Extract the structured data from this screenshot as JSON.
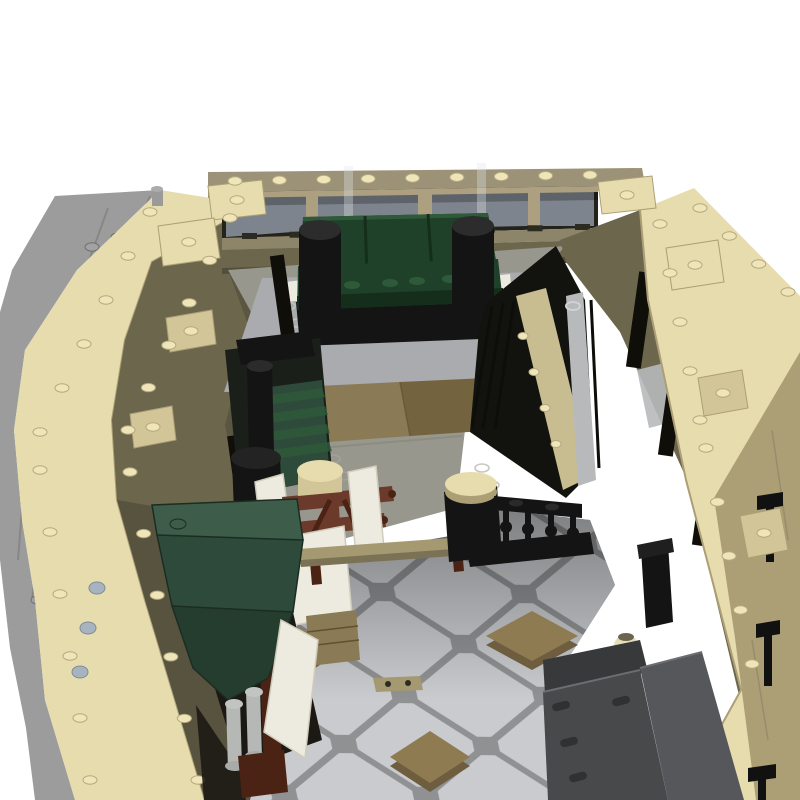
{
  "meta": {
    "title": "LEGO MOC modular building lobby - aerial 3D render",
    "alt": "Top-down angled render of a tan LEGO modular building with open roof showing a lobby: dark green sofa on a gray rug, rear window wall, wooden floor, brown coat stand with white privacy screens, black stair railing, dark green entrance awning with white door and gray columns, gray octagonal stone tile floor with dark tan diamond inlays, dark gray stone benches and black wall lamps, gray studded sidewalk baseplate along the left."
  },
  "colors": {
    "page_bg": "#ffffff",
    "plate": "#9c9c9c",
    "plate_seam": "#7f7f7f",
    "tan_bright": "#e6dcae",
    "tan_mid": "#d2c698",
    "tan_shadow": "#ac9f76",
    "tan_deep": "#8f8666",
    "olive": "#6c664d",
    "olive_dark": "#544f3a",
    "cornice": "#9c9277",
    "win_frame": "#23231c",
    "pane": "#7e848d",
    "mullion": "#aca081",
    "lintel": "#8d8569",
    "dash": "#2c2b22",
    "floor": "#98978d",
    "floor_seam": "#807f74",
    "rug": "#a9abae",
    "wood": "#8a7a55",
    "wood_dark": "#73643f",
    "green": "#1f4029",
    "green_lt": "#2e5a3a",
    "green_dk": "#152e1c",
    "black": "#141414",
    "pillar": "#b7b9bb",
    "steel": "#a7b4bf",
    "stair_tan": "#c8bc91",
    "awn1": "#3d5c4a",
    "awn2": "#2e4a3a",
    "awn3": "#253d2f",
    "awn_edge": "#1b2d22",
    "brown": "#6b3a2a",
    "brown_dk": "#4b2315",
    "white_panel": "#edebe0",
    "panel_edge": "#cfccbc",
    "bench_tan": "#a59972",
    "tile": "#c9cbce",
    "tile_gap": "#8f9193",
    "dia_top": "#8f7b52",
    "dia_side": "#6e5e3f",
    "bgray": "#47494b",
    "bgray2": "#55575a",
    "pill": "#2f3133",
    "vase": "#e6deb6",
    "stud_b": "#efe5b9",
    "stud_edge": "#b3a87e",
    "stud_g": "#a2a2a2",
    "stud_g_edge": "#6e6e6e",
    "void": "#12120e",
    "slit": "#0f0e09",
    "door_dark": "#1c1914",
    "lamp": "#111111"
  },
  "objects": {
    "building": "Tan LEGO modular building shell, open roof, viewed from above",
    "sidewalk": "Gray studded baseplate sidewalk along the left side",
    "back_windows": "Row of gray-blue windows on rear wall",
    "sofa": "Dark green three-seat sofa with black cylinder armrests",
    "rug": "Light gray area rug with stud marks",
    "wood_floor": "Dark tan wooden plank flooring",
    "green_stack": "Dark green rolled-awning stack with black pot and pipe",
    "coat_rack": "Reddish-brown coat stand with cream hat box",
    "screens": "White folding privacy screens",
    "bench": "Tan bench seat with dark legs",
    "stool": "Black stool with cream round cushion",
    "railing": "Black guard railing with turned balusters",
    "stairwell": "Open stair void with tan stringer and light gray column",
    "awning": "Dark green faceted entrance awning",
    "door": "White door panel leaning at the entrance",
    "columns": "Light gray turned porch columns on brown pedestal",
    "tile_floor": "Gray octagonal stone tile floor",
    "diamonds": "Dark tan diamond tile inlays",
    "stone_bench": "Dark gray stone bench slabs, bottom right",
    "vase": "Cream ribbed vase",
    "lamps": "Black wall lamps on right facade"
  },
  "decor": {
    "stud_rows_bright": [
      [
        150,
        212,
        40,
        432,
        6
      ],
      [
        40,
        470,
        90,
        780,
        6
      ],
      [
        230,
        218,
        128,
        430,
        6
      ],
      [
        130,
        472,
        198,
        780,
        6
      ],
      [
        660,
        224,
        700,
        420,
        5
      ],
      [
        706,
        448,
        752,
        664,
        5
      ],
      [
        700,
        208,
        788,
        292,
        4
      ],
      [
        235,
        181,
        590,
        175,
        9
      ]
    ],
    "stud_rows_gray": [
      [
        118,
        237,
        60,
        398,
        4
      ],
      [
        92,
        247,
        36,
        408,
        4
      ],
      [
        30,
        468,
        42,
        558,
        3
      ],
      [
        38,
        600,
        58,
        700,
        3
      ]
    ],
    "stringer_bumps": [
      [
        523,
        336
      ],
      [
        534,
        372
      ],
      [
        545,
        408
      ],
      [
        556,
        444
      ]
    ],
    "sofa_studs": [
      [
        325,
        287
      ],
      [
        352,
        285
      ],
      [
        390,
        283
      ],
      [
        417,
        281
      ],
      [
        450,
        279
      ],
      [
        477,
        277
      ]
    ],
    "slits": [
      [
        283,
        300,
        -8,
        14,
        90
      ],
      [
        258,
        390,
        -8,
        14,
        90
      ],
      [
        240,
        478,
        -8,
        14,
        86
      ],
      [
        230,
        562,
        -8,
        13,
        80
      ],
      [
        225,
        655,
        -6,
        13,
        66
      ],
      [
        245,
        735,
        -6,
        13,
        62
      ],
      [
        640,
        320,
        8,
        15,
        96
      ],
      [
        672,
        408,
        8,
        15,
        96
      ],
      [
        706,
        498,
        8,
        15,
        96
      ],
      [
        740,
        588,
        8,
        14,
        90
      ],
      [
        766,
        656,
        8,
        13,
        70
      ]
    ],
    "dashes": [
      242,
      233,
      575,
      224,
      8,
      15,
      6
    ],
    "balusters": [
      [
        506,
        512
      ],
      [
        528,
        514
      ],
      [
        551,
        516
      ],
      [
        573,
        518
      ]
    ],
    "stair_bars": [
      [
        492,
        306,
        472,
        428
      ],
      [
        503,
        303,
        483,
        428
      ],
      [
        514,
        301,
        495,
        429
      ],
      [
        591,
        300,
        599,
        468
      ]
    ],
    "louvers": [
      [
        264,
        396,
        322,
        388
      ],
      [
        266,
        414,
        325,
        406
      ],
      [
        268,
        432,
        327,
        424
      ],
      [
        270,
        450,
        329,
        442
      ]
    ],
    "pills": [
      [
        561,
        706
      ],
      [
        569,
        742
      ],
      [
        578,
        777
      ],
      [
        621,
        701
      ]
    ],
    "rug_crescents": [
      [
        288,
        306
      ],
      [
        297,
        323
      ],
      [
        527,
        300
      ],
      [
        536,
        317
      ],
      [
        303,
        371
      ],
      [
        558,
        366
      ]
    ],
    "floor_crescents": [
      [
        556,
        288
      ],
      [
        566,
        306
      ],
      [
        420,
        338
      ],
      [
        430,
        355
      ],
      [
        333,
        459
      ],
      [
        343,
        476
      ],
      [
        482,
        468
      ],
      [
        492,
        485
      ],
      [
        556,
        420
      ],
      [
        566,
        437
      ],
      [
        372,
        300
      ],
      [
        382,
        317
      ]
    ],
    "pipes": [
      [
        88,
        628
      ],
      [
        80,
        672
      ],
      [
        97,
        588
      ]
    ],
    "lamps": [
      [
        770,
        492,
        26,
        56
      ],
      [
        768,
        620,
        24,
        52
      ],
      [
        762,
        764,
        28,
        40
      ]
    ],
    "glass_sheets": [
      [
        344,
        166,
        9,
        66
      ],
      [
        477,
        163,
        9,
        64
      ]
    ],
    "blocks": [
      [
        208,
        186,
        262,
        180,
        266,
        214,
        212,
        220,
        "b"
      ],
      [
        158,
        226,
        214,
        218,
        220,
        258,
        163,
        266,
        "b"
      ],
      [
        166,
        318,
        212,
        310,
        216,
        344,
        170,
        352,
        "m"
      ],
      [
        130,
        414,
        172,
        406,
        176,
        440,
        134,
        448,
        "m"
      ],
      [
        598,
        182,
        652,
        176,
        656,
        208,
        602,
        214,
        "b"
      ],
      [
        666,
        248,
        718,
        240,
        724,
        282,
        672,
        290,
        "b"
      ],
      [
        698,
        378,
        742,
        370,
        748,
        408,
        704,
        416,
        "m"
      ],
      [
        740,
        516,
        780,
        508,
        788,
        550,
        748,
        558,
        "m"
      ]
    ],
    "diamonds": [
      [
        532,
        636,
        92,
        50
      ],
      [
        430,
        757,
        80,
        52
      ],
      [
        303,
        648,
        58,
        38
      ]
    ]
  }
}
